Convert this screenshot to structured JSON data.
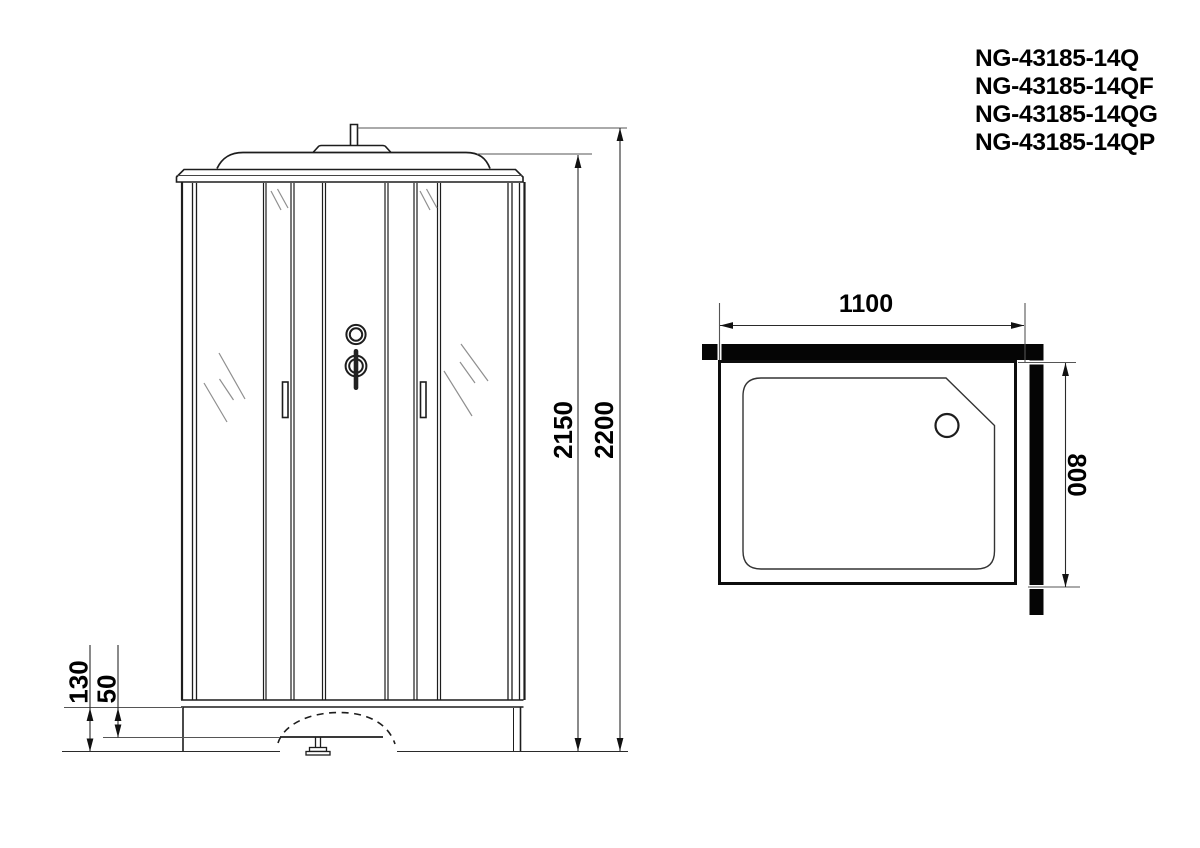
{
  "drawing": {
    "models": [
      "NG-43185-14Q",
      "NG-43185-14QF",
      "NG-43185-14QG",
      "NG-43185-14QP"
    ],
    "front_view": {
      "dim_overall_height": "2200",
      "dim_cabin_height": "2150",
      "dim_base_height": "130",
      "dim_tray_rim": "50"
    },
    "top_view": {
      "dim_width": "1100",
      "dim_depth": "800"
    },
    "colors": {
      "line": "#1d1d1d",
      "wall_fill": "#050505",
      "hatch": "#8f8f8f",
      "background": "#ffffff"
    }
  }
}
